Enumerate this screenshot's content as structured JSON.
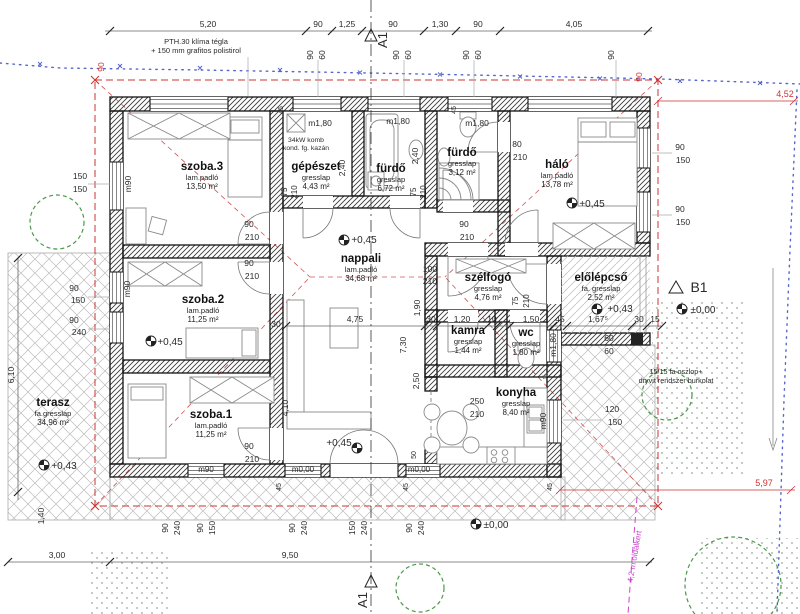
{
  "drawing": {
    "type": "floor-plan"
  },
  "rooms": [
    {
      "name": "szoba.3",
      "floor": "lam.padló",
      "area": "13,50 m²",
      "x": 202,
      "y": 170
    },
    {
      "name": "gépészet",
      "floor": "gresslap",
      "area": "4,43 m²",
      "x": 316,
      "y": 170
    },
    {
      "name": "fürdő",
      "floor": "gresslap",
      "area": "6,72 m²",
      "x": 391,
      "y": 172
    },
    {
      "name": "fürdő",
      "floor": "gresslap",
      "area": "3,12 m²",
      "x": 462,
      "y": 156
    },
    {
      "name": "háló",
      "floor": "lam.padló",
      "area": "13,78 m²",
      "x": 557,
      "y": 168
    },
    {
      "name": "nappali",
      "floor": "lam.padló",
      "area": "34,68 m²",
      "x": 361,
      "y": 262
    },
    {
      "name": "szoba.2",
      "floor": "lam.padló",
      "area": "11,25 m²",
      "x": 203,
      "y": 303
    },
    {
      "name": "szélfogó",
      "floor": "gresslap",
      "area": "4,76 m²",
      "x": 488,
      "y": 281
    },
    {
      "name": "előlépcső",
      "floor": "fa. gresslap",
      "area": "2,52 m²",
      "x": 601,
      "y": 281
    },
    {
      "name": "kamra",
      "floor": "gresslap",
      "area": "1,44 m²",
      "x": 468,
      "y": 334
    },
    {
      "name": "wc",
      "floor": "gresslap",
      "area": "1,80 m²",
      "x": 526,
      "y": 336
    },
    {
      "name": "konyha",
      "floor": "gresslap",
      "area": "8,40 m²",
      "x": 516,
      "y": 396
    },
    {
      "name": "szoba.1",
      "floor": "lam.padló",
      "area": "11,25 m²",
      "x": 211,
      "y": 418
    },
    {
      "name": "terasz",
      "floor": "fa.gresslap",
      "area": "34,96 m²",
      "x": 53,
      "y": 406
    }
  ],
  "annotations": [
    {
      "t": "5,20",
      "x": 208,
      "y": 27
    },
    {
      "t": "90",
      "x": 318,
      "y": 27
    },
    {
      "t": "1,25",
      "x": 347,
      "y": 27
    },
    {
      "t": "90",
      "x": 393,
      "y": 27
    },
    {
      "t": "1,30",
      "x": 440,
      "y": 27
    },
    {
      "t": "90",
      "x": 478,
      "y": 27
    },
    {
      "t": "4,05",
      "x": 574,
      "y": 27
    },
    {
      "t": "90",
      "x": 313,
      "y": 55,
      "r": -90
    },
    {
      "t": "60",
      "x": 325,
      "y": 55,
      "r": -90
    },
    {
      "t": "90",
      "x": 399,
      "y": 55,
      "r": -90
    },
    {
      "t": "60",
      "x": 411,
      "y": 55,
      "r": -90
    },
    {
      "t": "90",
      "x": 469,
      "y": 55,
      "r": -90
    },
    {
      "t": "60",
      "x": 481,
      "y": 55,
      "r": -90
    },
    {
      "t": "90",
      "x": 614,
      "y": 55,
      "r": -90
    },
    {
      "t": "90",
      "x": 104,
      "y": 67,
      "r": -90,
      "c": "#cc3333"
    },
    {
      "t": "90",
      "x": 642,
      "y": 77,
      "r": -90,
      "c": "#cc3333"
    },
    {
      "t": "4,52",
      "x": 785,
      "y": 97,
      "c": "#cc3333",
      "s": 9
    },
    {
      "t": "5,97",
      "x": 764,
      "y": 486,
      "c": "#cc3333",
      "s": 9
    },
    {
      "t": "PTH.30 klíma tégla",
      "x": 196,
      "y": 44,
      "s": 7.5
    },
    {
      "t": "+ 150 mm grafitos polistirol",
      "x": 196,
      "y": 53,
      "s": 7.5
    },
    {
      "t": "34kW komb",
      "x": 306,
      "y": 142,
      "s": 6.8
    },
    {
      "t": "kond. fg. kazán",
      "x": 306,
      "y": 150,
      "s": 6.8
    },
    {
      "t": "15/15 fa oszlop+",
      "x": 676,
      "y": 374,
      "s": 7.2
    },
    {
      "t": "dryvit rendszer burkolat",
      "x": 676,
      "y": 383,
      "s": 7.2
    },
    {
      "t": "4,2 m oldalkert",
      "x": 637,
      "y": 557,
      "r": -80,
      "c": "#cc44cc",
      "s": 8
    },
    {
      "t": "150",
      "x": 80,
      "y": 179
    },
    {
      "t": "150",
      "x": 80,
      "y": 192
    },
    {
      "t": "90",
      "x": 74,
      "y": 291
    },
    {
      "t": "150",
      "x": 78,
      "y": 303
    },
    {
      "t": "90",
      "x": 74,
      "y": 323
    },
    {
      "t": "240",
      "x": 79,
      "y": 335
    },
    {
      "t": "6,10",
      "x": 14,
      "y": 375,
      "r": -90
    },
    {
      "t": "1,40",
      "x": 44,
      "y": 516,
      "r": -90
    },
    {
      "t": "3,00",
      "x": 57,
      "y": 558
    },
    {
      "t": "9,50",
      "x": 290,
      "y": 558
    },
    {
      "t": "m90",
      "x": 131,
      "y": 184,
      "r": -90
    },
    {
      "t": "m90",
      "x": 130,
      "y": 289,
      "r": -90
    },
    {
      "t": "m90",
      "x": 206,
      "y": 472,
      "s": 8
    },
    {
      "t": "m0,00",
      "x": 303,
      "y": 472,
      "s": 8
    },
    {
      "t": "m0,00",
      "x": 419,
      "y": 472,
      "s": 8
    },
    {
      "t": "m90",
      "x": 546,
      "y": 421,
      "r": -90
    },
    {
      "t": "m1,80",
      "x": 556,
      "y": 345,
      "r": -90
    },
    {
      "t": "m1,80",
      "x": 320,
      "y": 126
    },
    {
      "t": "m1,80",
      "x": 398,
      "y": 124
    },
    {
      "t": "m1,80",
      "x": 477,
      "y": 126
    },
    {
      "t": "90",
      "x": 168,
      "y": 528,
      "r": -90
    },
    {
      "t": "240",
      "x": 180,
      "y": 528,
      "r": -90
    },
    {
      "t": "90",
      "x": 203,
      "y": 528,
      "r": -90
    },
    {
      "t": "150",
      "x": 215,
      "y": 528,
      "r": -90
    },
    {
      "t": "90",
      "x": 295,
      "y": 528,
      "r": -90
    },
    {
      "t": "240",
      "x": 307,
      "y": 528,
      "r": -90
    },
    {
      "t": "150",
      "x": 355,
      "y": 528,
      "r": -90
    },
    {
      "t": "240",
      "x": 367,
      "y": 528,
      "r": -90
    },
    {
      "t": "90",
      "x": 412,
      "y": 528,
      "r": -90
    },
    {
      "t": "240",
      "x": 424,
      "y": 528,
      "r": -90
    },
    {
      "t": "45",
      "x": 283,
      "y": 110,
      "r": -90,
      "s": 7
    },
    {
      "t": "45",
      "x": 456,
      "y": 110,
      "r": -90,
      "s": 7
    },
    {
      "t": "45",
      "x": 281,
      "y": 487,
      "r": -90,
      "s": 7
    },
    {
      "t": "45",
      "x": 408,
      "y": 487,
      "r": -90,
      "s": 7
    },
    {
      "t": "45",
      "x": 552,
      "y": 487,
      "r": -90,
      "s": 7
    },
    {
      "t": "50",
      "x": 416,
      "y": 455,
      "r": -90,
      "s": 7
    },
    {
      "t": "90",
      "x": 680,
      "y": 150
    },
    {
      "t": "150",
      "x": 683,
      "y": 163
    },
    {
      "t": "90",
      "x": 680,
      "y": 212
    },
    {
      "t": "150",
      "x": 683,
      "y": 225
    },
    {
      "t": "120",
      "x": 612,
      "y": 412
    },
    {
      "t": "150",
      "x": 615,
      "y": 425
    },
    {
      "t": "90",
      "x": 249,
      "y": 227
    },
    {
      "t": "210",
      "x": 252,
      "y": 240
    },
    {
      "t": "90",
      "x": 249,
      "y": 266
    },
    {
      "t": "210",
      "x": 252,
      "y": 279
    },
    {
      "t": "90",
      "x": 249,
      "y": 449
    },
    {
      "t": "210",
      "x": 252,
      "y": 462
    },
    {
      "t": "90",
      "x": 464,
      "y": 227
    },
    {
      "t": "210",
      "x": 467,
      "y": 240
    },
    {
      "t": "80",
      "x": 517,
      "y": 147
    },
    {
      "t": "210",
      "x": 520,
      "y": 160
    },
    {
      "t": "100",
      "x": 430,
      "y": 272
    },
    {
      "t": "210",
      "x": 430,
      "y": 284
    },
    {
      "t": "75",
      "x": 287,
      "y": 192,
      "r": -90,
      "s": 8
    },
    {
      "t": "210",
      "x": 297,
      "y": 192,
      "r": -90,
      "s": 8
    },
    {
      "t": "75",
      "x": 416,
      "y": 192,
      "r": -90,
      "s": 8
    },
    {
      "t": "210",
      "x": 426,
      "y": 192,
      "r": -90,
      "s": 8
    },
    {
      "t": "75",
      "x": 518,
      "y": 301,
      "r": -90,
      "s": 8
    },
    {
      "t": "210",
      "x": 529,
      "y": 301,
      "r": -90,
      "s": 8
    },
    {
      "t": "2,40",
      "x": 345,
      "y": 168,
      "r": -90
    },
    {
      "t": "2,40",
      "x": 418,
      "y": 156,
      "r": -90
    },
    {
      "t": "4,75",
      "x": 355,
      "y": 322
    },
    {
      "t": "30",
      "x": 431,
      "y": 322
    },
    {
      "t": "1,20",
      "x": 462,
      "y": 322
    },
    {
      "t": "10",
      "x": 492,
      "y": 322
    },
    {
      "t": "7,30",
      "x": 406,
      "y": 345,
      "r": -90
    },
    {
      "t": "1,90",
      "x": 420,
      "y": 308,
      "r": -90
    },
    {
      "t": "4,10",
      "x": 288,
      "y": 408,
      "r": -90
    },
    {
      "t": "2,50",
      "x": 419,
      "y": 381,
      "r": -90
    },
    {
      "t": "30",
      "x": 276,
      "y": 327
    },
    {
      "t": "1,50",
      "x": 531,
      "y": 322
    },
    {
      "t": "45",
      "x": 560,
      "y": 322
    },
    {
      "t": "1,67⁵",
      "x": 598,
      "y": 322
    },
    {
      "t": "30",
      "x": 639,
      "y": 322
    },
    {
      "t": "15",
      "x": 655,
      "y": 322
    },
    {
      "t": "60",
      "x": 609,
      "y": 341
    },
    {
      "t": "60",
      "x": 609,
      "y": 354
    },
    {
      "t": "250",
      "x": 477,
      "y": 404
    },
    {
      "t": "210",
      "x": 477,
      "y": 417
    },
    {
      "t": "*",
      "x": 545,
      "y": 384,
      "s": 15,
      "c": "#666"
    },
    {
      "t": "+0,45",
      "x": 364,
      "y": 243,
      "s": 10
    },
    {
      "t": "+0,45",
      "x": 592,
      "y": 207,
      "s": 10
    },
    {
      "t": "+0,45",
      "x": 170,
      "y": 345,
      "s": 10
    },
    {
      "t": "+0,45",
      "x": 339,
      "y": 446,
      "s": 10
    },
    {
      "t": "+0,43",
      "x": 64,
      "y": 469,
      "s": 10
    },
    {
      "t": "+0,43",
      "x": 620,
      "y": 312,
      "s": 10
    },
    {
      "t": "±0,00",
      "x": 703,
      "y": 313,
      "s": 10
    },
    {
      "t": "±0,00",
      "x": 496,
      "y": 528,
      "s": 10
    },
    {
      "t": "A1",
      "x": 387,
      "y": 40,
      "r": -90,
      "s": 13,
      "f": 1
    },
    {
      "t": "A1",
      "x": 367,
      "y": 600,
      "r": -90,
      "s": 13,
      "f": 1
    },
    {
      "t": "B1",
      "x": 699,
      "y": 292,
      "s": 14,
      "f": 1
    }
  ]
}
